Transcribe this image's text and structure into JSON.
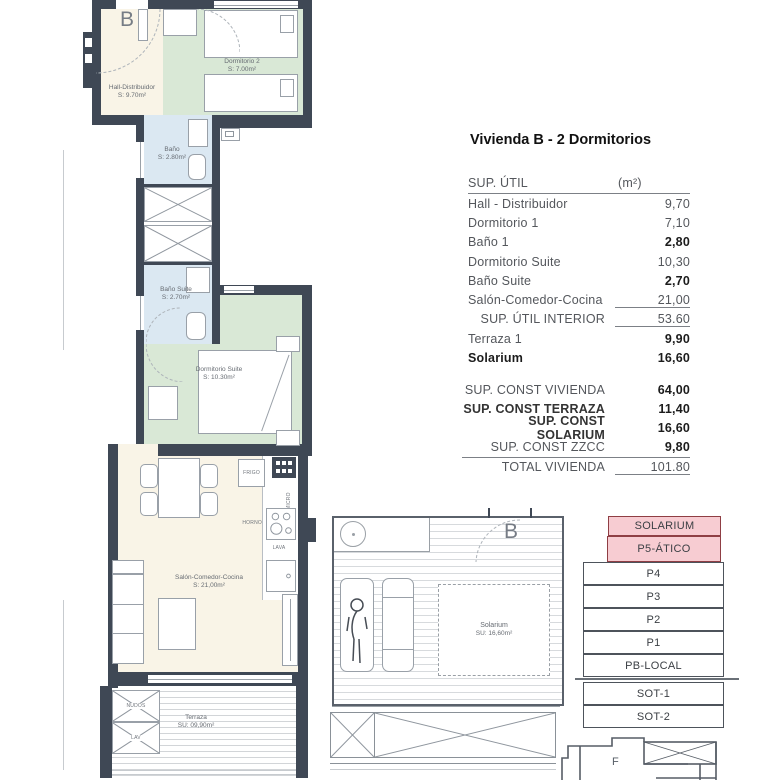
{
  "title": "Vivienda B - 2 Dormitorios",
  "area_table": {
    "header": {
      "label": "SUP. ÚTIL",
      "unit": "(m²)"
    },
    "rows": [
      {
        "label": "Hall - Distribuidor",
        "value": "9,70"
      },
      {
        "label": "Dormitorio 1",
        "value": "7,10"
      },
      {
        "label": "Baño 1",
        "value": "2,80"
      },
      {
        "label": "Dormitorio Suite",
        "value": "10,30"
      },
      {
        "label": "Baño Suite",
        "value": "2,70"
      },
      {
        "label": "Salón-Comedor-Cocina",
        "value": "21,00"
      },
      {
        "label": "SUP. ÚTIL INTERIOR",
        "value": "53.60"
      },
      {
        "label": "Terraza 1",
        "value": "9,90"
      },
      {
        "label": "Solarium",
        "value": "16,60"
      }
    ],
    "totals": [
      {
        "label": "SUP. CONST VIVIENDA",
        "value": "64,00"
      },
      {
        "label": "SUP. CONST TERRAZA",
        "value": "11,40"
      },
      {
        "label": "SUP. CONST SOLARIUM",
        "value": "16,60"
      },
      {
        "label": "SUP. CONST ZZCC",
        "value": "9,80"
      },
      {
        "label": "TOTAL VIVIENDA",
        "value": "101.80"
      }
    ]
  },
  "floor_plan": {
    "unit_letter": "B",
    "hall": {
      "name": "Hall-Distribuidor",
      "area": "S: 9.70m²"
    },
    "bedroom2": {
      "name": "Dormitorio 2",
      "area": "S: 7.00m²"
    },
    "bath1": {
      "name": "Baño",
      "area": "S: 2.80m²"
    },
    "bath_suite": {
      "name": "Baño Suite",
      "area": "S: 2.70m²"
    },
    "bedroom_suite": {
      "name": "Dormitorio Suite",
      "area": "S: 10.30m²"
    },
    "living": {
      "name": "Salón-Comedor-Cocina",
      "area": "S: 21,00m²"
    },
    "terrace": {
      "name": "Terraza",
      "area": "SU: 09,90m²"
    },
    "kitchen_labels": {
      "fridge": "FRIGO",
      "microwave": "MICRO",
      "oven": "HORNO",
      "washer": "LAVA"
    },
    "terrace_labels": {
      "box1": "NUDOS",
      "box2": "LAV"
    }
  },
  "solarium_plan": {
    "unit_letter": "B",
    "name": "Solarium",
    "area": "SU: 16,60m²"
  },
  "level_stack": {
    "levels": [
      {
        "label": "SOLARIUM",
        "highlight": true
      },
      {
        "label": "P5-ÁTICO",
        "highlight": true
      },
      {
        "label": "P4",
        "highlight": false
      },
      {
        "label": "P3",
        "highlight": false
      },
      {
        "label": "P2",
        "highlight": false
      },
      {
        "label": "P1",
        "highlight": false
      },
      {
        "label": "PB-LOCAL",
        "highlight": false
      },
      {
        "label": "SOT-1",
        "highlight": false
      },
      {
        "label": "SOT-2",
        "highlight": false
      }
    ],
    "mini_plan_letter": "F"
  },
  "colors": {
    "wall": "#3f4855",
    "hall_floor": "#f9f4e7",
    "bedroom_floor": "#d9e8d6",
    "bath_floor": "#dbe8f2",
    "highlight_fill": "#f7ccd2",
    "highlight_border": "#8f3e44"
  }
}
